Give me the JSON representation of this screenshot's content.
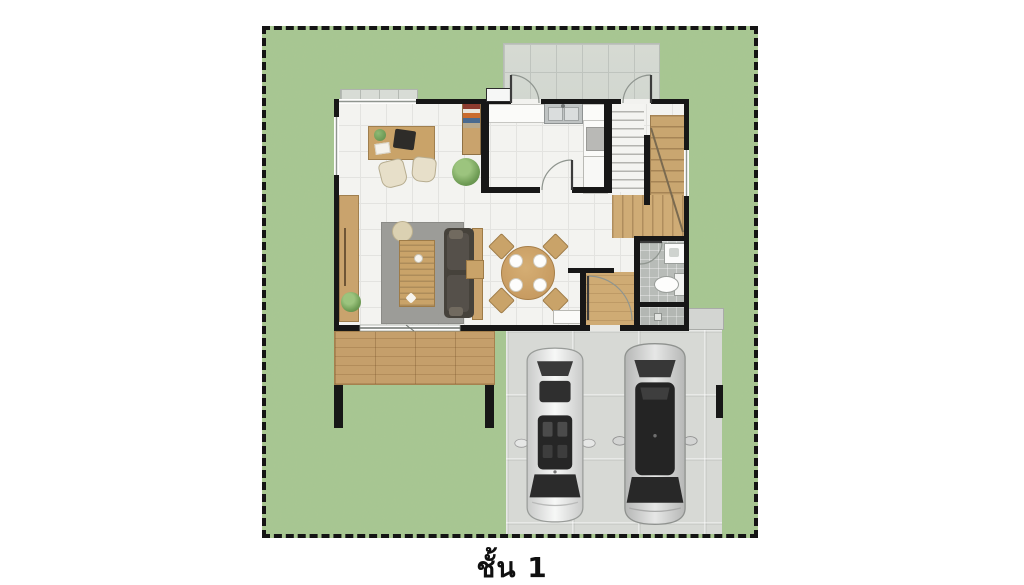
{
  "caption": {
    "floor_label": "ชั้น 1"
  },
  "site": {
    "boundary": {
      "stroke_style": "dashed",
      "color": "#141414"
    },
    "lawn_color": "#a8c791",
    "areas": [
      "lawn",
      "terrace",
      "house",
      "wood-deck",
      "garage",
      "entry-step"
    ]
  },
  "house": {
    "wall_color": "#171717",
    "floor_color": "#f3f3f0",
    "rooms": [
      {
        "id": "office",
        "furniture": [
          "desk",
          "monitor",
          "desk-plant",
          "office-chair",
          "office-chair",
          "bookshelf",
          "floor-plant"
        ]
      },
      {
        "id": "kitchen",
        "furniture": [
          "counter",
          "double-sink",
          "stove",
          "fridge"
        ]
      },
      {
        "id": "living-room",
        "furniture": [
          "sideboard",
          "rug",
          "coffee-table",
          "pouf",
          "sofa",
          "sofa-console",
          "side-table",
          "floor-plant"
        ]
      },
      {
        "id": "dining-area",
        "furniture": [
          "round-dining-table",
          "dining-chair",
          "dining-chair",
          "dining-chair",
          "dining-chair",
          "plates",
          "shoe-bench"
        ]
      },
      {
        "id": "stair-hall",
        "furniture": [
          "staircase-upper-dashed",
          "staircase-winder",
          "staircase-lower-flight"
        ]
      },
      {
        "id": "bathroom",
        "furniture": [
          "wash-basin",
          "toilet",
          "shower-drain"
        ]
      },
      {
        "id": "entry-hall",
        "furniture": []
      }
    ],
    "openings": [
      "terrace-door-left",
      "terrace-door-right",
      "kitchen-door",
      "entry-door",
      "bathroom-door",
      "sliding-glass-door",
      "window-office",
      "window-left",
      "window-right"
    ]
  },
  "garage": {
    "floor_color": "#d7d9d5",
    "vehicles": [
      {
        "id": "car-white-sedan",
        "body_color": "#f2f3f2",
        "glass_color": "#2d2d2d"
      },
      {
        "id": "car-silver-sedan",
        "body_color": "#d8d9d7",
        "glass_color": "#2a2a2a"
      }
    ]
  },
  "materials": {
    "wood": "#c9a369",
    "deck_wood": "#c59f6b",
    "rug": "#9c9c98",
    "terrace_tile": "#d6dad3",
    "bath_tile": "#b8bcb8"
  }
}
